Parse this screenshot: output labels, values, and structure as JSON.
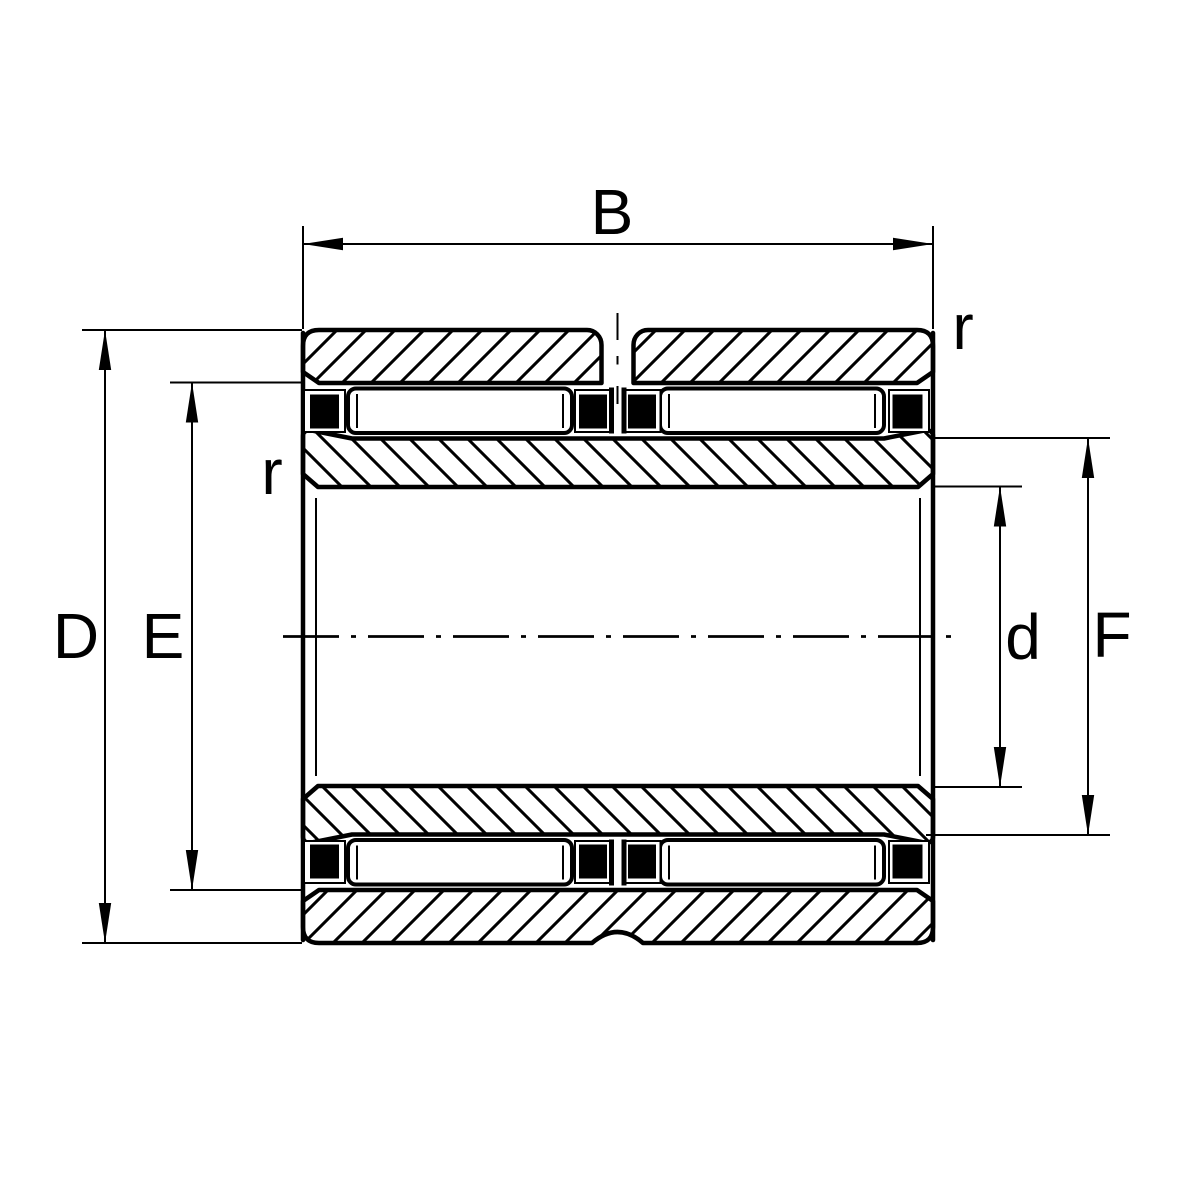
{
  "colors": {
    "line": "#000000",
    "background": "#ffffff"
  },
  "dimensions": {
    "width_label": "B",
    "outer_diameter_label": "D",
    "outer_raceway_label": "E",
    "inner_raceway_label": "F",
    "bore_label": "d",
    "chamfer_label_left": "r",
    "chamfer_label_right": "r"
  }
}
